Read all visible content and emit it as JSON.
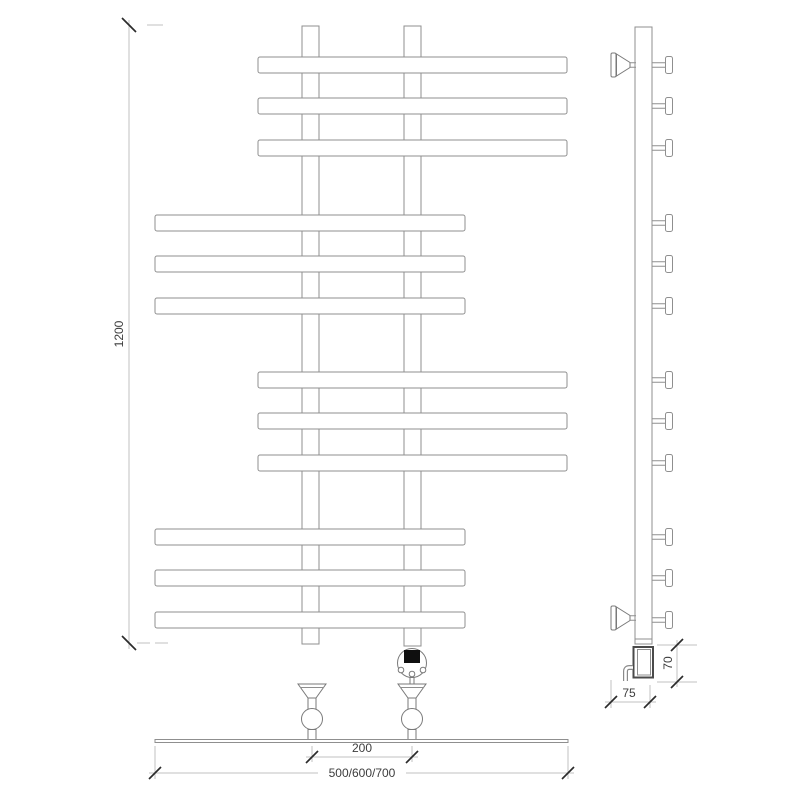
{
  "dimensions": {
    "height": "1200",
    "connection_spacing": "200",
    "width_options": "500/600/700",
    "wall_offset": "75",
    "heater_height": "70"
  },
  "colors": {
    "background": "#ffffff",
    "outline": "#8f8f8f",
    "dimension_line": "#c2c2c2",
    "tick": "#2b2b2b",
    "label_text": "#3d3d3d",
    "controller_display": "#0f0f0f"
  }
}
